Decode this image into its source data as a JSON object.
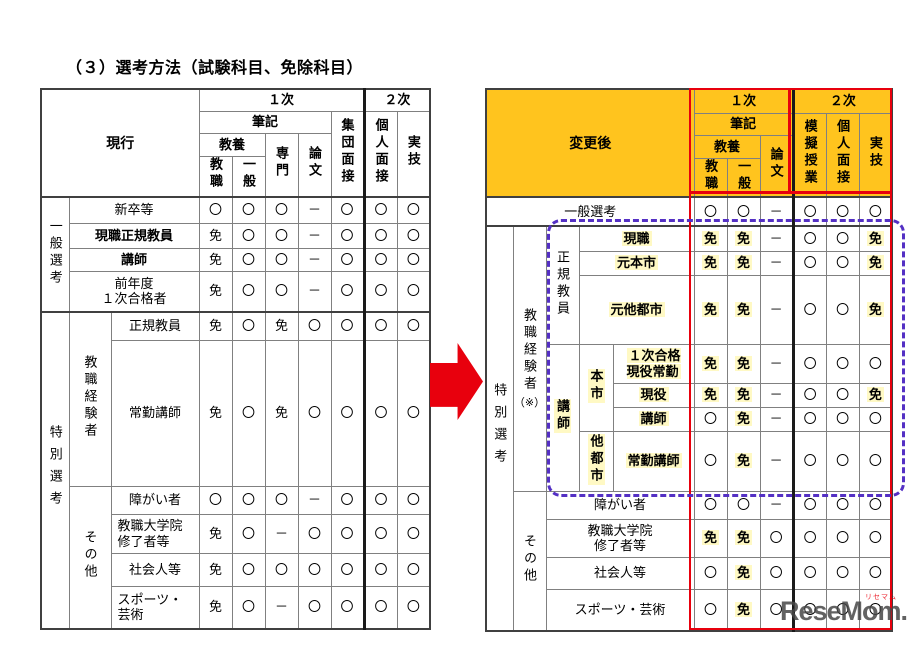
{
  "title": "（３）選考方法（試験科目、免除科目）",
  "marks": {
    "required": "〇",
    "exempt": "免",
    "none": "－"
  },
  "colors": {
    "header_orange": "#FFC41E",
    "highlight_yellow": "#FFF9C4",
    "frame_red": "#E8000D",
    "dashed_purple": "#5430C4",
    "arrow_red": "#E8000D"
  },
  "left_table": {
    "corner": "現行",
    "header": {
      "round1": "１次",
      "round2": "２次",
      "written": "筆記",
      "liberal": "教養",
      "teaching": "教職",
      "general": "一般",
      "specialty": "専門",
      "essay": "論文",
      "group_interview": "集団面接",
      "individual_interview": "個人面接",
      "practical": "実技"
    },
    "groups": {
      "general": "一般選考",
      "special": "特別選考",
      "experienced": "教職経験者",
      "other": "その他"
    },
    "rows": [
      {
        "label": "新卒等",
        "cells": [
          "〇",
          "〇",
          "〇",
          "－",
          "〇",
          "〇",
          "〇"
        ]
      },
      {
        "label": "現職正規教員",
        "cells": [
          "免",
          "〇",
          "〇",
          "－",
          "〇",
          "〇",
          "〇"
        ]
      },
      {
        "label": "講師",
        "cells": [
          "免",
          "〇",
          "〇",
          "－",
          "〇",
          "〇",
          "〇"
        ]
      },
      {
        "label": "前年度\n１次合格者",
        "cells": [
          "免",
          "〇",
          "〇",
          "－",
          "〇",
          "〇",
          "〇"
        ]
      },
      {
        "label": "正規教員",
        "cells": [
          "免",
          "〇",
          "免",
          "〇",
          "〇",
          "〇",
          "〇"
        ]
      },
      {
        "label": "常勤講師",
        "cells": [
          "免",
          "〇",
          "免",
          "〇",
          "〇",
          "〇",
          "〇"
        ]
      },
      {
        "label": "障がい者",
        "cells": [
          "〇",
          "〇",
          "〇",
          "－",
          "〇",
          "〇",
          "〇"
        ]
      },
      {
        "label": "教職大学院\n修了者等",
        "cells": [
          "免",
          "〇",
          "－",
          "〇",
          "〇",
          "〇",
          "〇"
        ]
      },
      {
        "label": "社会人等",
        "cells": [
          "免",
          "〇",
          "〇",
          "〇",
          "〇",
          "〇",
          "〇"
        ]
      },
      {
        "label": "スポーツ・\n芸術",
        "cells": [
          "免",
          "〇",
          "－",
          "〇",
          "〇",
          "〇",
          "〇"
        ]
      }
    ]
  },
  "right_table": {
    "corner": "変更後",
    "header": {
      "round1": "１次",
      "round2": "２次",
      "written": "筆記",
      "liberal": "教養",
      "teaching": "教職",
      "general": "一般",
      "essay": "論文",
      "mock_lesson": "模擬授業",
      "individual_interview": "個人面接",
      "practical": "実技"
    },
    "groups": {
      "special": "特別選考",
      "experienced": "教職経験者",
      "experienced_note": "（※）",
      "regular": "正規教員",
      "lecturer": "講師",
      "this_city": "本市",
      "other_city": "他都市",
      "other": "その他"
    },
    "rows": [
      {
        "label": "一般選考",
        "cells": [
          "〇",
          "〇",
          "－",
          "〇",
          "〇",
          "〇"
        ]
      },
      {
        "label": "現職",
        "cells": [
          "免",
          "免",
          "－",
          "〇",
          "〇",
          "免"
        ]
      },
      {
        "label": "元本市",
        "cells": [
          "免",
          "免",
          "－",
          "〇",
          "〇",
          "免"
        ]
      },
      {
        "label": "元他都市",
        "cells": [
          "免",
          "免",
          "－",
          "〇",
          "〇",
          "免"
        ]
      },
      {
        "label": "１次合格\n現役常勤",
        "cells": [
          "免",
          "免",
          "－",
          "〇",
          "〇",
          "〇"
        ]
      },
      {
        "label": "現役",
        "cells": [
          "免",
          "免",
          "－",
          "〇",
          "〇",
          "免"
        ]
      },
      {
        "label": "講師",
        "cells": [
          "〇",
          "免",
          "－",
          "〇",
          "〇",
          "〇"
        ]
      },
      {
        "label": "常勤講師",
        "cells": [
          "〇",
          "免",
          "－",
          "〇",
          "〇",
          "〇"
        ]
      },
      {
        "label": "障がい者",
        "cells": [
          "〇",
          "〇",
          "－",
          "〇",
          "〇",
          "〇"
        ]
      },
      {
        "label": "教職大学院\n修了者等",
        "cells": [
          "免",
          "免",
          "〇",
          "〇",
          "〇",
          "〇"
        ]
      },
      {
        "label": "社会人等",
        "cells": [
          "〇",
          "免",
          "〇",
          "〇",
          "〇",
          "〇"
        ]
      },
      {
        "label": "スポーツ・芸術",
        "cells": [
          "〇",
          "免",
          "〇",
          "〇",
          "〇",
          "〇"
        ]
      }
    ]
  },
  "watermark": {
    "brand": "ReseMom.",
    "brand_ruby": "リセマム"
  }
}
